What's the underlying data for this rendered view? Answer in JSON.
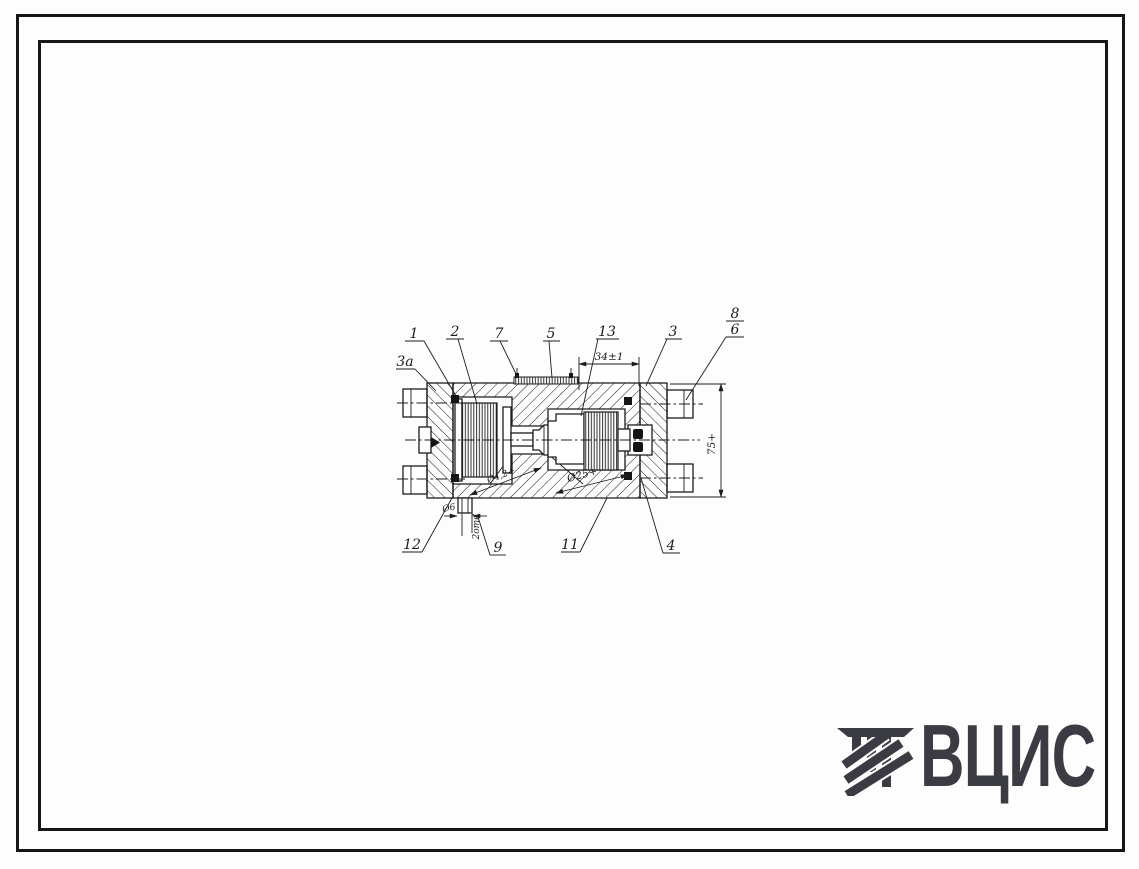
{
  "page": {
    "background": "#fdfdfd",
    "ink": "#1c1c1c"
  },
  "drawing": {
    "callouts": {
      "c1": "1",
      "c2": "2",
      "c3": "3",
      "c3a": "3а",
      "c4": "4",
      "c5": "5",
      "c6": "6",
      "c7": "7",
      "c8": "8",
      "c9": "9",
      "c11": "11",
      "c12": "12",
      "c13": "13"
    },
    "dimensions": {
      "width_top": "34±1",
      "height_right": "75+",
      "bore_right": "Ø25+",
      "bore_left": "Ø4,2+",
      "hole_bottom": "Ø6",
      "hole_count": "2отв"
    }
  },
  "logo": {
    "text": "ВЦИС",
    "color": "#3b3b43"
  }
}
